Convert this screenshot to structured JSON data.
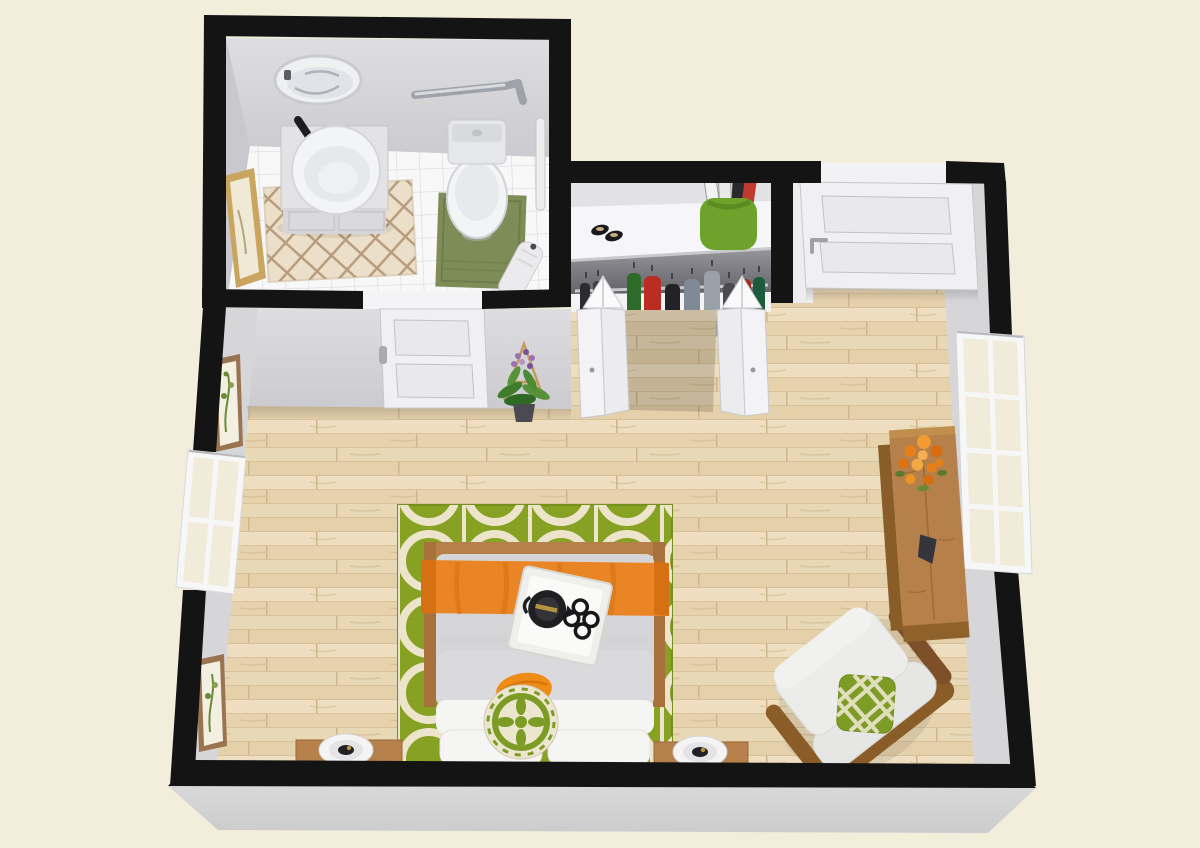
{
  "scene": {
    "type": "3d-floor-plan-render",
    "view": "top-down bird's eye",
    "rooms": [
      "bathroom",
      "closet",
      "entry",
      "studio-bedroom"
    ]
  },
  "colors": {
    "cream": "#f2eedb",
    "wall-black": "#141414",
    "wall-face": "#d6d6d9",
    "wall-face-dark": "#c9c9cd",
    "skirt": "#d3d3d4",
    "floor-base": "#ebdaba",
    "floor-gap": "#d8c29c",
    "tile": "#f8f8f9",
    "tile-line": "#dadadd",
    "rug-green": "#87a122",
    "rug-pattern": "#ece5cc",
    "bed-duvet": "#d5d5d7",
    "bed-white": "#f5f5f3",
    "orange": "#ea8526",
    "orange-dark": "#d06c0e",
    "wood-furniture": "#b5804a",
    "wood-dark": "#8a5c28",
    "bath-mat": "#7e8d58",
    "bath-rug": "#ebdfc9",
    "bath-rug-line": "#ae8f6f",
    "basket-green": "#6da32b",
    "pillow-green": "#7d9c26",
    "cloth-red": "#b92d23",
    "cloth-green": "#2e6b2a",
    "fixture-white": "#f3f4f6",
    "fixture-shadow": "#d2d3d6",
    "door-white": "#f0f0f2",
    "door-edge": "#c7c7cb",
    "metal": "#9fa3a9",
    "teapot-black": "#1f1f22",
    "gold": "#b5933e",
    "flower-orange": "#e67f17",
    "plant-green": "#3f7d2c",
    "flower-purple": "#9b6fb5",
    "frame-gold": "#c9a55f",
    "frame-wood": "#9a7350"
  },
  "bathroom": {
    "floor": "white tile",
    "items": [
      "oval-wall-mirror",
      "vanity-with-vessel-sink",
      "black-faucet",
      "toilet",
      "grab-bar-horizontal",
      "grab-bar-vertical",
      "green-bath-mat",
      "cream-lattice-rug",
      "leaning-gold-framed-art",
      "hanging-towel"
    ]
  },
  "closet": {
    "shelf_items": [
      "black-sandals",
      "green-basket-with-magazines"
    ],
    "hanging_clothes_colors": [
      "black",
      "dark-gray",
      "green",
      "red",
      "gray-blue",
      "light-gray",
      "dark-red"
    ],
    "doors": "white bifold doors, open"
  },
  "entry": {
    "items": [
      "two-panel-entry-door"
    ]
  },
  "bedroom": {
    "floor": "light wood planks",
    "items": [
      "green-trellis-area-rug",
      "bed-with-gray-duvet",
      "orange-bed-runner",
      "white-serving-tray",
      "black-teapot",
      "four-black-cups",
      "orange-throw-pillow",
      "green-medallion-round-pillow",
      "white-pillows",
      "nightstand-left",
      "nightstand-right",
      "table-lamp-left",
      "table-lamp-right",
      "armchair-with-green-lattice-pillow",
      "tall-wood-dresser",
      "orange-flower-bouquet",
      "dark-decor-object",
      "potted-plant-purple-flowers",
      "bathroom-door",
      "left-window",
      "right-window",
      "botanical-wall-art-upper",
      "botanical-wall-art-lower"
    ]
  }
}
